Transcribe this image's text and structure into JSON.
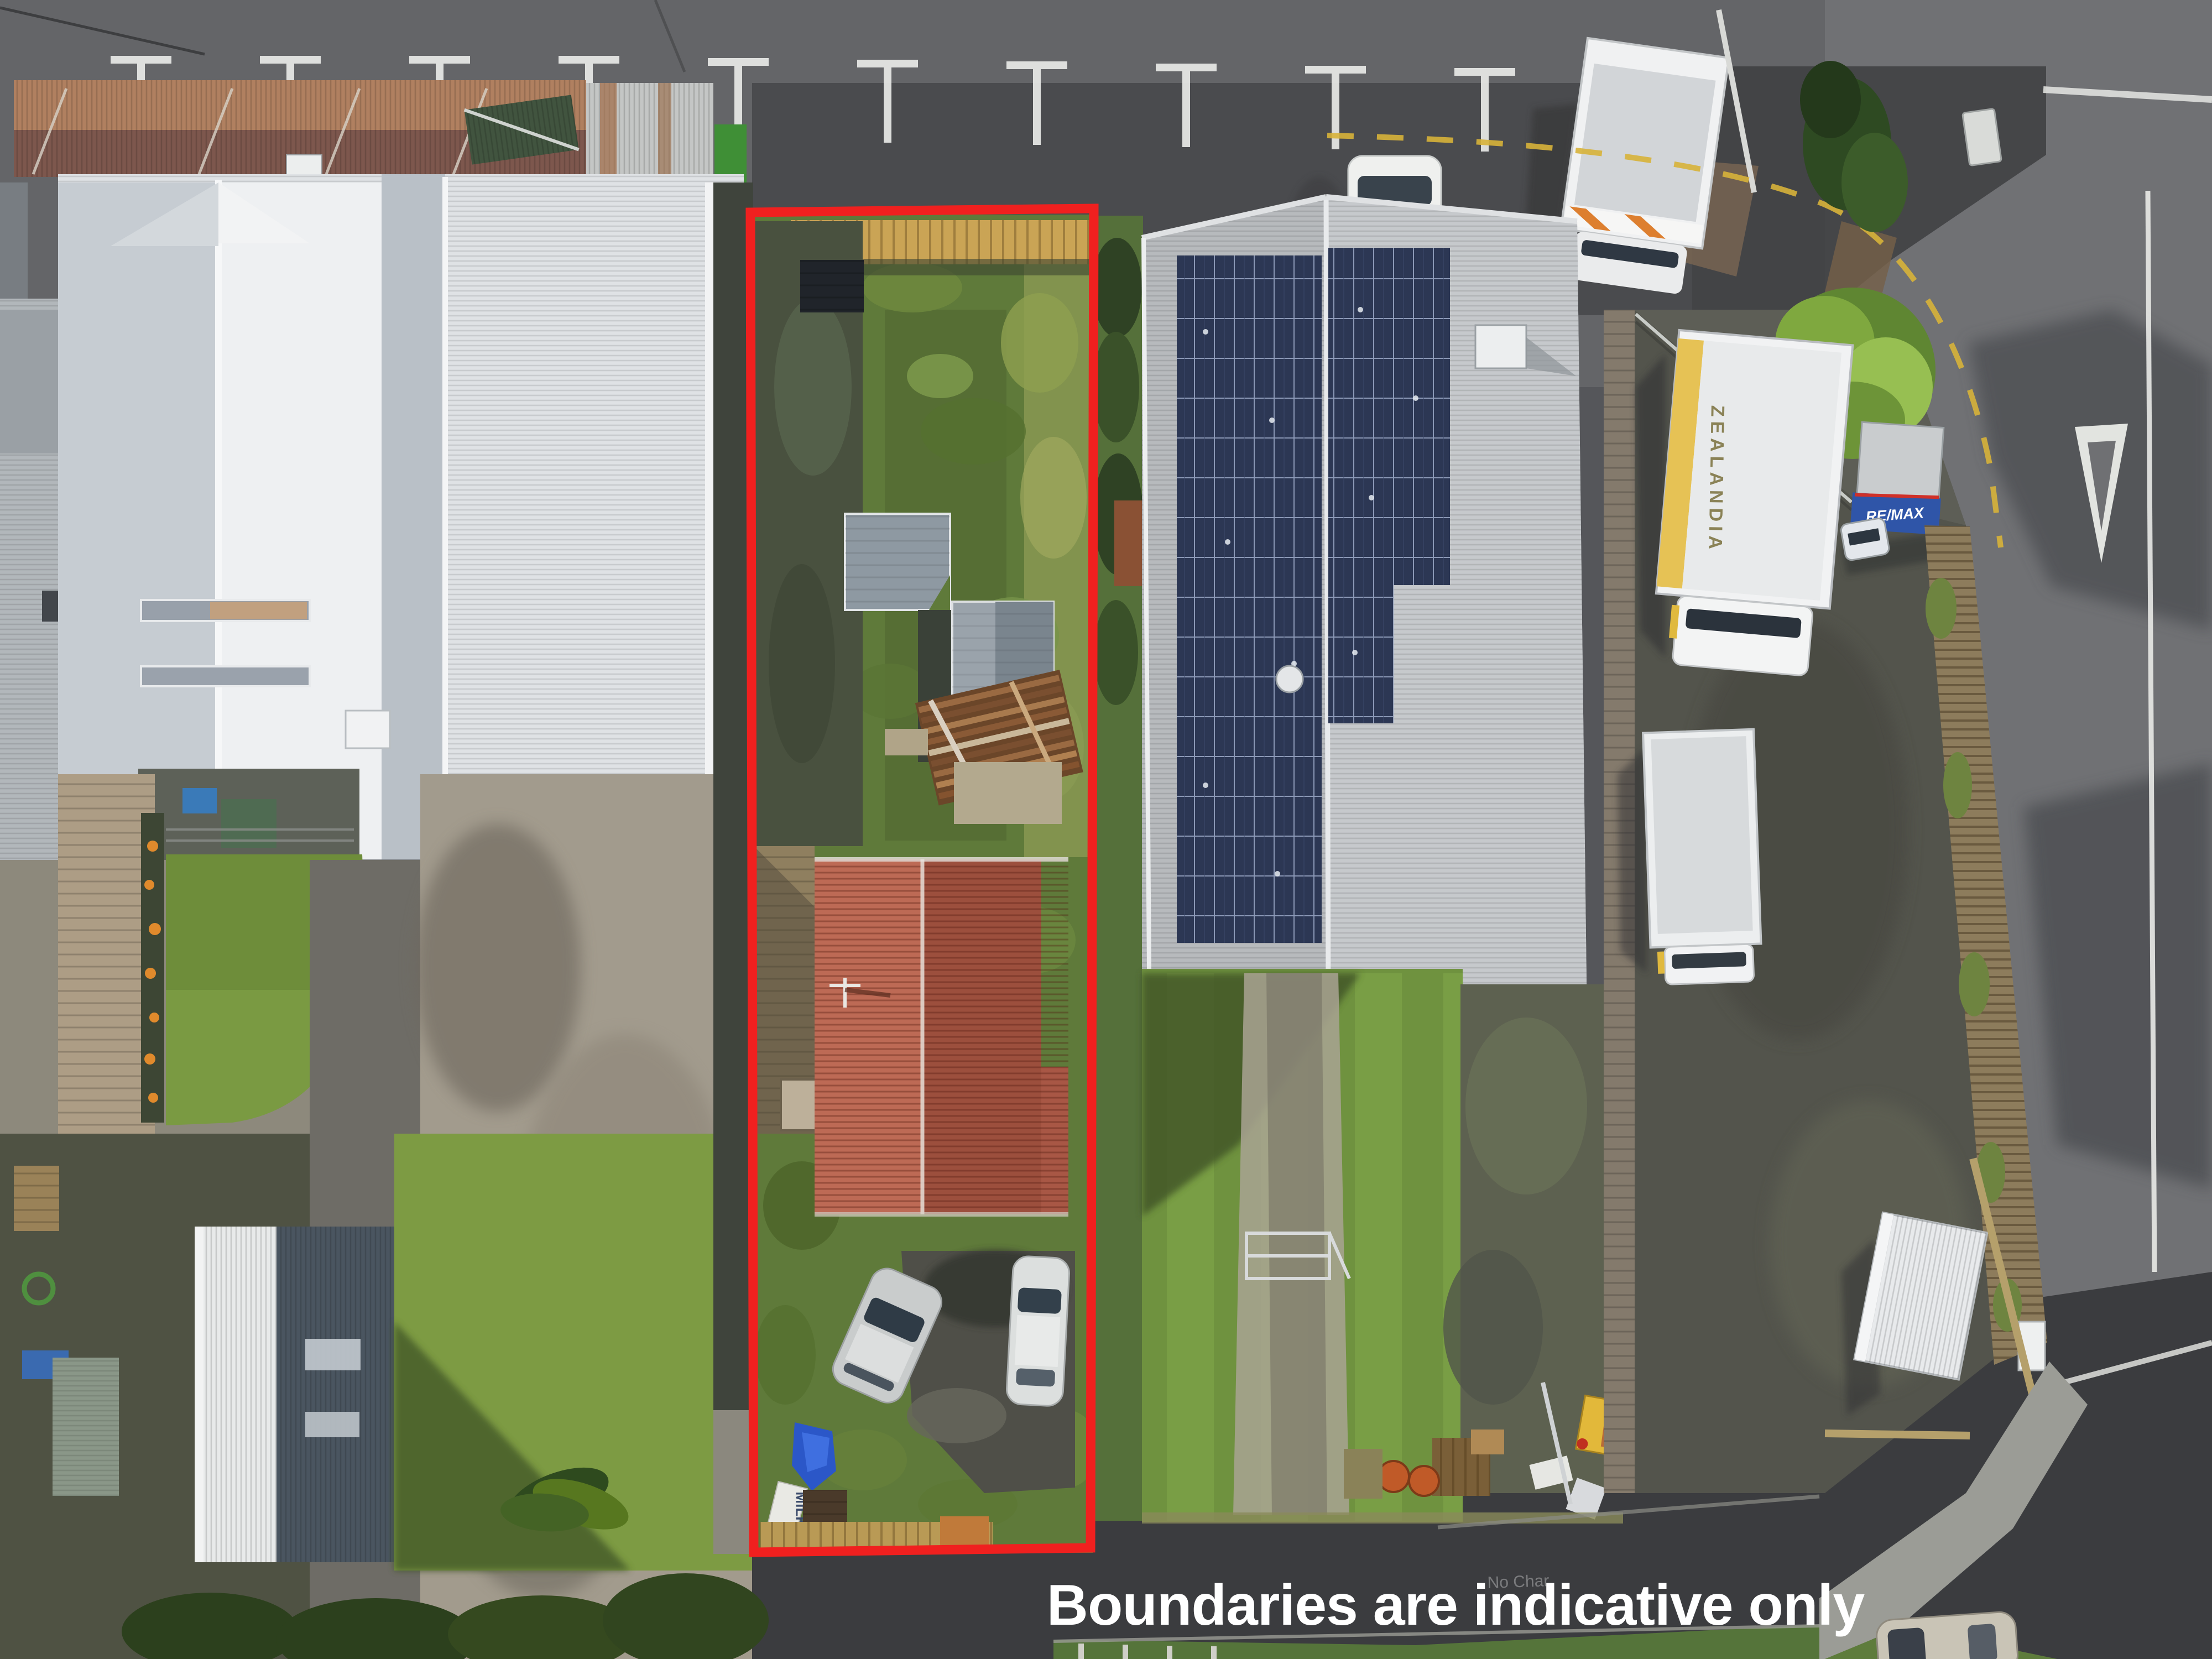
{
  "overlay": {
    "caption": "Boundaries are indicative only",
    "caption_color": "#ffffff",
    "boundary_color": "#f0201f"
  },
  "scene": {
    "labels": {
      "truck_zealandia": "ZEALANDIA",
      "truck_remax": "RE/MAX",
      "milk_sign": "MILK",
      "road_graffiti": "No Char"
    },
    "palette": {
      "asphalt_top": "#646568",
      "asphalt_right": "#707174",
      "asphalt_bottom": "#3b3c3f",
      "white_roof": "#e4e7ea",
      "solar_panel": "#2c3754",
      "red_roof_light": "#bd6a55",
      "red_roof_dark": "#9c4f3d",
      "rust_fence": "#b08060",
      "grass_bright": "#7d9b43",
      "grass_scruffy": "#5f7a3a",
      "concrete": "#a29b8d"
    }
  }
}
